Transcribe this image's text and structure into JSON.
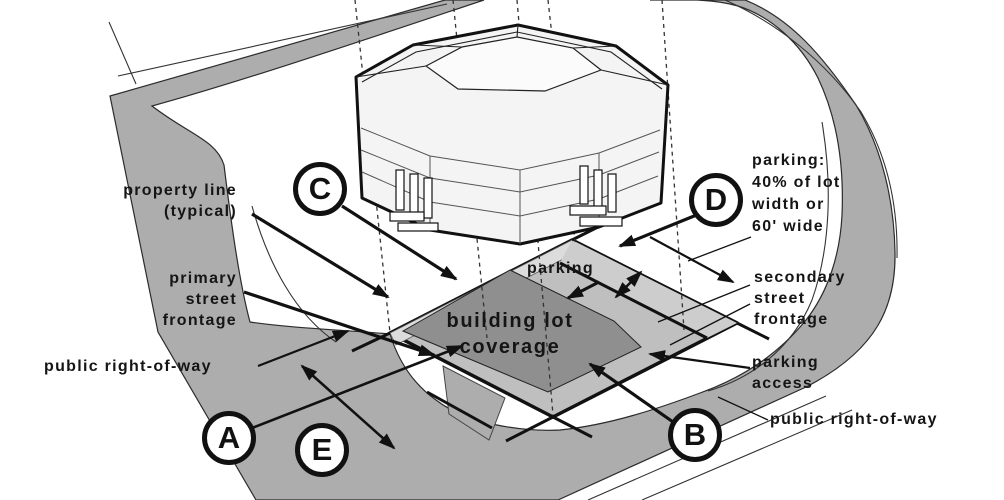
{
  "diagram": {
    "kind": "zoning-site-diagram",
    "labels": {
      "property_line": {
        "line1": "property line",
        "line2": "(typical)"
      },
      "primary_street_frontage": {
        "line1": "primary",
        "line2": "street",
        "line3": "frontage"
      },
      "public_right_of_way_left": {
        "line1": "public right-of-way"
      },
      "parking_center": {
        "line1": "parking"
      },
      "building_lot_coverage": {
        "line1": "building lot",
        "line2": "coverage"
      },
      "parking_spec": {
        "line1": "parking:",
        "line2": "40% of lot",
        "line3": "width or",
        "line4": "60' wide"
      },
      "secondary_street_frontage": {
        "line1": "secondary",
        "line2": "street",
        "line3": "frontage"
      },
      "parking_access": {
        "line1": "parking",
        "line2": "access"
      },
      "public_right_of_way_right": {
        "line1": "public right-of-way"
      }
    },
    "markers": {
      "a": "A",
      "b": "B",
      "c": "C",
      "d": "D",
      "e": "E"
    },
    "colors": {
      "street_gray": "#adadad",
      "lot_gray": "#bfbfbf",
      "parking_strip_gray": "#cdcdcd",
      "coverage_gray": "#8f8f8f",
      "sidewalk_edge_gray": "#dcdcdc",
      "building_fill": "#f4f4f4",
      "ink": "#111111"
    }
  }
}
